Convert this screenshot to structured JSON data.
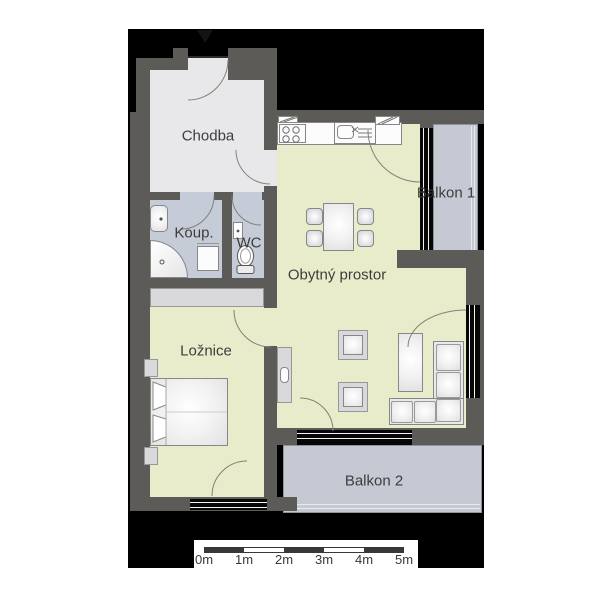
{
  "floorplan": {
    "rooms": [
      {
        "id": "chodba",
        "label": "Chodba"
      },
      {
        "id": "koupelna",
        "label": "Koup."
      },
      {
        "id": "wc",
        "label": "WC"
      },
      {
        "id": "obytny-prostor",
        "label": "Obytný prostor"
      },
      {
        "id": "loznice",
        "label": "Ložnice"
      },
      {
        "id": "balkon-1",
        "label": "Balkon 1"
      },
      {
        "id": "balkon-2",
        "label": "Balkon 2"
      }
    ],
    "scale_bar": {
      "labels": [
        "0m",
        "1m",
        "2m",
        "3m",
        "4m",
        "5m"
      ]
    },
    "colors": {
      "page_background": "#ffffff",
      "plan_backdrop": "#000000",
      "walls": "#5c5b57",
      "hallway_floor": "#e8e8ea",
      "bathroom_floor": "#c6cbd8",
      "living_floor": "#e9ecca",
      "balcony_floor": "#c5c9d3",
      "label_text": "#3d3d3d",
      "scale_bar": "#383838"
    }
  }
}
